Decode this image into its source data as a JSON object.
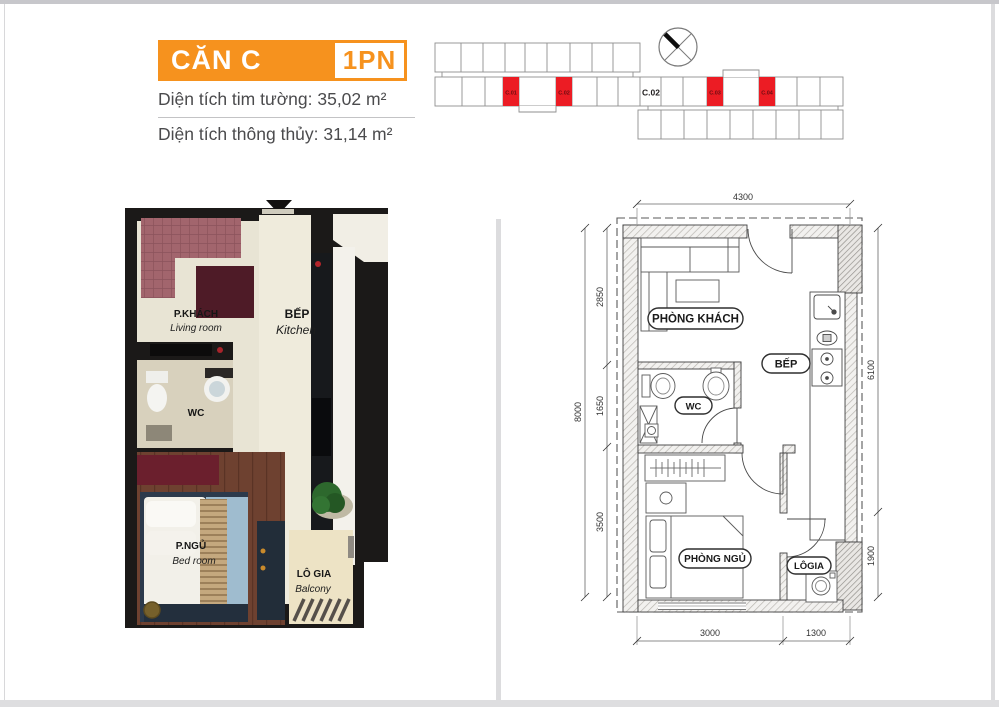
{
  "header": {
    "unit_label": "CĂN C",
    "bedroom_badge": "1PN",
    "gross_area_label": "Diện tích tim tường: 35,02 m²",
    "net_area_label": "Diện tích thông thủy: 31,14 m²"
  },
  "site_diagram": {
    "red_units": [
      "C.01",
      "C.02",
      "C.03",
      "C.04"
    ],
    "block_label": "C.02",
    "highlight_color": "#EC1C24"
  },
  "render_plan": {
    "living_vi": "P.KHÁCH",
    "living_en": "Living room",
    "kitchen_vi": "BẾP",
    "kitchen_en": "Kitchen",
    "wc_label": "WC",
    "bedroom_vi": "P.NGỦ",
    "bedroom_en": "Bed room",
    "balcony_vi": "LÔ GIA",
    "balcony_en": "Balcony"
  },
  "floor_plan": {
    "room_living": "PHÒNG KHÁCH",
    "room_kitchen": "BẾP",
    "room_wc": "WC",
    "room_bedroom": "PHÒNG NGỦ",
    "room_balcony": "LÔGIA",
    "dims": {
      "top": "4300",
      "left_total": "8000",
      "left_seg1": "2850",
      "left_seg2": "1650",
      "left_seg3": "3500",
      "right_seg1": "6100",
      "right_seg2": "1900",
      "bottom_seg1": "3000",
      "bottom_seg2": "1300"
    }
  },
  "colors": {
    "accent_orange": "#F6921E",
    "unit_red": "#EC1C24"
  }
}
